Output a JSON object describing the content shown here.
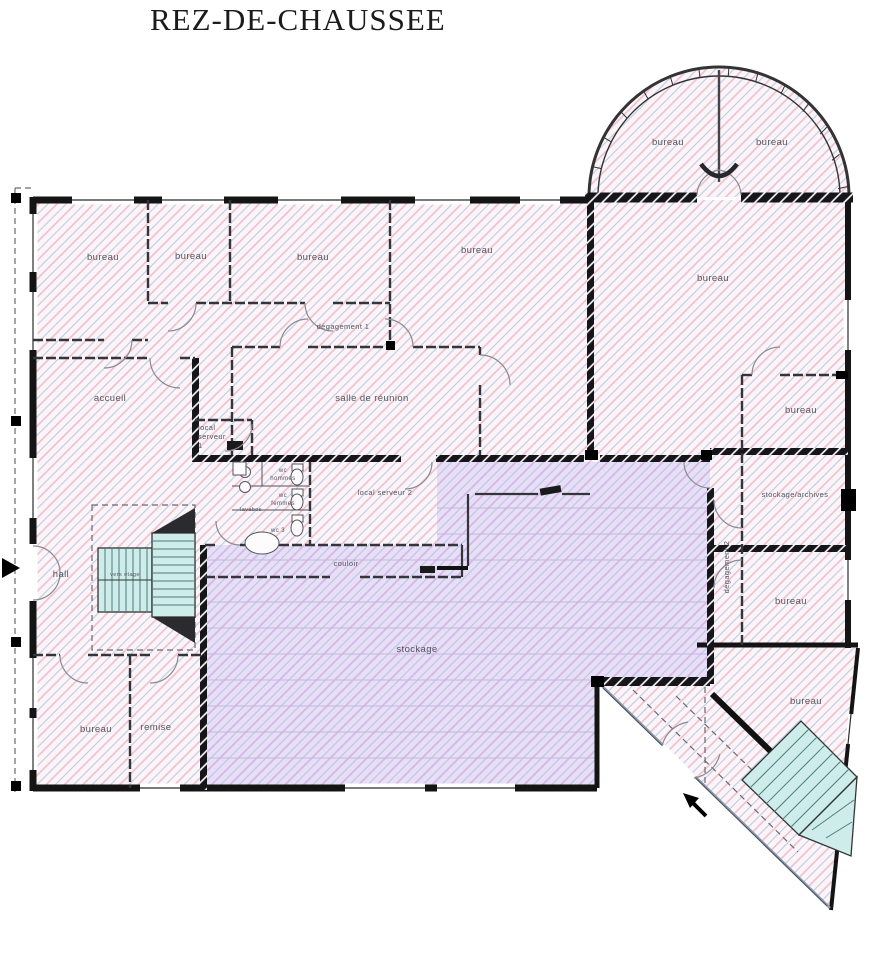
{
  "title": "REZ-DE-CHAUSSEE",
  "colors": {
    "wall": "#141414",
    "room_fill": "#fcf4f7",
    "hatch_pink": "#e8c0d2",
    "hatch_blue": "#bdcbe4",
    "storage_fill": "#e8def5",
    "storage_hatch": "#cdb8e6",
    "stair_fill": "#cdecea",
    "arrow": "#000000"
  },
  "rooms": {
    "tower_left": {
      "label": "bureau"
    },
    "tower_right": {
      "label": "bureau"
    },
    "top_1": {
      "label": "bureau"
    },
    "top_2": {
      "label": "bureau"
    },
    "top_3": {
      "label": "bureau"
    },
    "top_4": {
      "label": "bureau"
    },
    "right_large": {
      "label": "bureau"
    },
    "degagement_1": {
      "label": "dégagement 1"
    },
    "accueil": {
      "label": "accueil"
    },
    "salle_reunion": {
      "label": "salle de réunion"
    },
    "local_serveur_1": {
      "line1": "local",
      "line2": "serveur",
      "line3": "1"
    },
    "local_serveur_2": {
      "label": "local serveur 2"
    },
    "wc_hommes": {
      "line1": "wc",
      "line2": "hommes"
    },
    "wc_femmes": {
      "line1": "wc",
      "line2": "femmes"
    },
    "wc_3": {
      "label": "wc 3"
    },
    "lavabos": {
      "label": "lavabos"
    },
    "couloir": {
      "label": "couloir"
    },
    "stockage": {
      "label": "stockage"
    },
    "hall": {
      "label": "hall"
    },
    "stairs_main": {
      "label": "vers étage"
    },
    "bureau_sw": {
      "label": "bureau"
    },
    "remise": {
      "label": "remise"
    },
    "right_col_top": {
      "label": "bureau"
    },
    "stockage_archives": {
      "label": "stockage/archives"
    },
    "degagement_2": {
      "label": "dégagement 2"
    },
    "right_col_mid": {
      "label": "bureau"
    },
    "bureau_se": {
      "label": "bureau"
    }
  }
}
